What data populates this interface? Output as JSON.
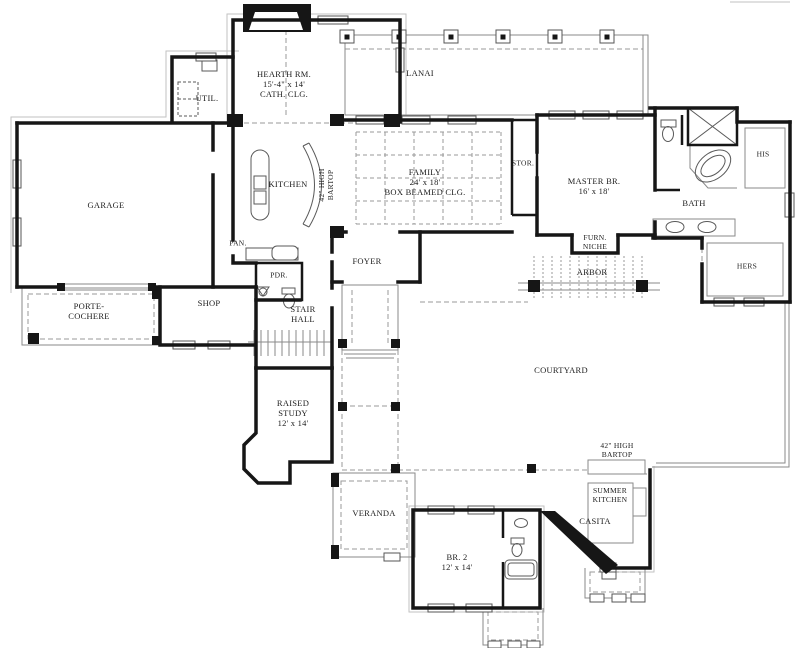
{
  "plan": {
    "type": "house-floor-plan",
    "colors": {
      "wall": "#161616",
      "thin_line": "#8a8a8a",
      "dashed_line": "#9a9a9a",
      "text": "#1c1c1c",
      "background": "#ffffff"
    },
    "rooms": {
      "hearth": {
        "l1": "HEARTH RM.",
        "l2": "15'-4\" x 14'",
        "l3": "CATH. CLG."
      },
      "lanai": {
        "l1": "LANAI"
      },
      "util": {
        "l1": "UTIL."
      },
      "garage": {
        "l1": "GARAGE"
      },
      "kitchen": {
        "l1": "KITCHEN"
      },
      "kitchen_bartop": {
        "l1": "42\" HIGH",
        "l2": "BARTOP"
      },
      "family": {
        "l1": "FAMILY",
        "l2": "24' x 18'",
        "l3": "BOX BEAMED CLG."
      },
      "storage": {
        "l1": "STOR."
      },
      "master": {
        "l1": "MASTER BR.",
        "l2": "16' x 18'"
      },
      "bath": {
        "l1": "BATH"
      },
      "his_closet": {
        "l1": "HIS"
      },
      "hers_closet": {
        "l1": "HERS"
      },
      "furn_niche": {
        "l1": "FURN.",
        "l2": "NICHE"
      },
      "arbor": {
        "l1": "ARBOR"
      },
      "pantry": {
        "l1": "PAN."
      },
      "powder": {
        "l1": "PDR."
      },
      "foyer": {
        "l1": "FOYER"
      },
      "shop": {
        "l1": "SHOP"
      },
      "porte_cochere": {
        "l1": "PORTE-",
        "l2": "COCHERE"
      },
      "stair_hall": {
        "l1": "STAIR",
        "l2": "HALL"
      },
      "raised_study": {
        "l1": "RAISED",
        "l2": "STUDY",
        "l3": "12' x 14'"
      },
      "courtyard": {
        "l1": "COURTYARD"
      },
      "summer_bartop": {
        "l1": "42\" HIGH",
        "l2": "BARTOP"
      },
      "summer_kitchen": {
        "l1": "SUMMER",
        "l2": "KITCHEN"
      },
      "casita": {
        "l1": "CASITA"
      },
      "veranda": {
        "l1": "VERANDA"
      },
      "bedroom2": {
        "l1": "BR. 2",
        "l2": "12' x 14'"
      }
    }
  }
}
